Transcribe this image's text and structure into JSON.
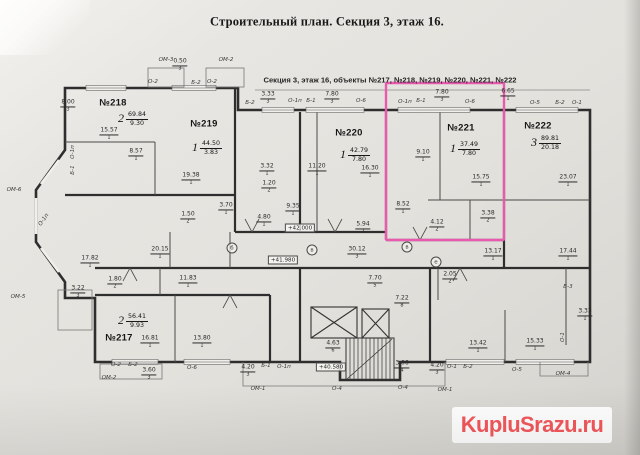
{
  "header": {
    "title": "Строительный план. Секция 3, этаж 16.",
    "subtitle": "Секция 3, этаж 16, объекты №217, №218, №219, №220, №221, №222"
  },
  "watermark": {
    "text": "KupluSrazu.ru",
    "color": "#f4555a",
    "background": "#ffffff"
  },
  "plan": {
    "ink_color": "#2e2e2e",
    "paper_color": "#e6e4e0",
    "highlight_color": "#e85aae",
    "highlighted_unit": "№221",
    "apartments": [
      {
        "id": "№218",
        "rooms": "2",
        "total_area": "69.84",
        "living_area": "9.30",
        "id_x": 113,
        "id_y": 103,
        "area_x": 133,
        "area_y": 119
      },
      {
        "id": "№219",
        "rooms": "1",
        "total_area": "44.50",
        "living_area": "3.83",
        "id_x": 204,
        "id_y": 124,
        "area_x": 207,
        "area_y": 148
      },
      {
        "id": "№220",
        "rooms": "1",
        "total_area": "42.79",
        "living_area": "7.80",
        "id_x": 349,
        "id_y": 133,
        "area_x": 355,
        "area_y": 155
      },
      {
        "id": "№221",
        "rooms": "1",
        "total_area": "37.49",
        "living_area": "7.80",
        "id_x": 461,
        "id_y": 128,
        "area_x": 465,
        "area_y": 149
      },
      {
        "id": "№222",
        "rooms": "3",
        "total_area": "89.81",
        "living_area": "20.18",
        "id_x": 538,
        "id_y": 126,
        "area_x": 546,
        "area_y": 143
      },
      {
        "id": "№217",
        "rooms": "2",
        "total_area": "56.41",
        "living_area": "9.93",
        "id_x": 119,
        "id_y": 338,
        "area_x": 133,
        "area_y": 321
      }
    ],
    "dims": [
      {
        "t": "15.57",
        "d": "1",
        "x": 109,
        "y": 134
      },
      {
        "t": "8.57",
        "d": "1",
        "x": 136,
        "y": 155
      },
      {
        "t": "19.38",
        "d": "1",
        "x": 191,
        "y": 179
      },
      {
        "t": "1.50",
        "d": "2",
        "x": 188,
        "y": 218
      },
      {
        "t": "3.70",
        "d": "1",
        "x": 226,
        "y": 209
      },
      {
        "t": "3.32",
        "d": "1",
        "x": 267,
        "y": 170
      },
      {
        "t": "1.20",
        "d": "2",
        "x": 269,
        "y": 187
      },
      {
        "t": "9.35",
        "d": "1",
        "x": 293,
        "y": 210
      },
      {
        "t": "4.80",
        "d": "1",
        "x": 264,
        "y": 221
      },
      {
        "t": "11.20",
        "d": "1",
        "x": 317,
        "y": 170
      },
      {
        "t": "16.30",
        "d": "1",
        "x": 370,
        "y": 172
      },
      {
        "t": "5.94",
        "d": "2",
        "x": 363,
        "y": 228
      },
      {
        "t": "9.10",
        "d": "1",
        "x": 423,
        "y": 156
      },
      {
        "t": "15.75",
        "d": "1",
        "x": 481,
        "y": 181
      },
      {
        "t": "8.52",
        "d": "1",
        "x": 403,
        "y": 208
      },
      {
        "t": "4.12",
        "d": "2",
        "x": 437,
        "y": 226
      },
      {
        "t": "3.38",
        "d": "2",
        "x": 488,
        "y": 217
      },
      {
        "t": "23.07",
        "d": "1",
        "x": 568,
        "y": 181
      },
      {
        "t": "20.15",
        "d": "1",
        "x": 160,
        "y": 253
      },
      {
        "t": "17.82",
        "d": "1",
        "x": 90,
        "y": 262
      },
      {
        "t": "1.80",
        "d": "2",
        "x": 115,
        "y": 283
      },
      {
        "t": "11.83",
        "d": "1",
        "x": 188,
        "y": 282
      },
      {
        "t": "3.22",
        "d": "3",
        "x": 78,
        "y": 292
      },
      {
        "t": "16.81",
        "d": "1",
        "x": 150,
        "y": 342
      },
      {
        "t": "13.80",
        "d": "1",
        "x": 202,
        "y": 342
      },
      {
        "t": "30.12",
        "d": "3",
        "x": 357,
        "y": 253
      },
      {
        "t": "7.70",
        "d": "5",
        "x": 375,
        "y": 282
      },
      {
        "t": "7.22",
        "d": "8",
        "x": 402,
        "y": 302
      },
      {
        "t": "2.05",
        "d": "2",
        "x": 450,
        "y": 278
      },
      {
        "t": "13.17",
        "d": "1",
        "x": 493,
        "y": 255
      },
      {
        "t": "17.44",
        "d": "1",
        "x": 568,
        "y": 255
      },
      {
        "t": "3.33",
        "d": "1",
        "x": 585,
        "y": 315
      },
      {
        "t": "13.42",
        "d": "1",
        "x": 478,
        "y": 347
      },
      {
        "t": "15.33",
        "d": "1",
        "x": 535,
        "y": 345
      },
      {
        "t": "4.63",
        "d": "6",
        "x": 333,
        "y": 347
      },
      {
        "t": "3.06",
        "d": "4",
        "x": 402,
        "y": 367
      },
      {
        "t": "4.20",
        "d": "3",
        "x": 248,
        "y": 371
      },
      {
        "t": "3.60",
        "d": "3",
        "x": 149,
        "y": 374
      },
      {
        "t": "4.20",
        "d": "3",
        "x": 437,
        "y": 369
      },
      {
        "t": "8.00",
        "d": "3",
        "x": 68,
        "y": 106
      },
      {
        "t": "0.50",
        "d": "3",
        "x": 180,
        "y": 65
      },
      {
        "t": "3.33",
        "d": "3",
        "x": 268,
        "y": 98
      },
      {
        "t": "7.80",
        "d": "3",
        "x": 332,
        "y": 98
      },
      {
        "t": "7.80",
        "d": "3",
        "x": 442,
        "y": 96
      },
      {
        "t": "6.65",
        "d": "1",
        "x": 508,
        "y": 95
      }
    ],
    "tags": [
      {
        "t": "ОМ-3",
        "x": 166,
        "y": 60
      },
      {
        "t": "ОМ-2",
        "x": 226,
        "y": 60
      },
      {
        "t": "О-2",
        "x": 153,
        "y": 82
      },
      {
        "t": "Б-2",
        "x": 196,
        "y": 83
      },
      {
        "t": "О-2",
        "x": 212,
        "y": 82
      },
      {
        "t": "Б-2",
        "x": 250,
        "y": 103
      },
      {
        "t": "О-1п",
        "x": 295,
        "y": 101
      },
      {
        "t": "Б-1",
        "x": 311,
        "y": 101
      },
      {
        "t": "О-6",
        "x": 361,
        "y": 101
      },
      {
        "t": "О-1п",
        "x": 405,
        "y": 102
      },
      {
        "t": "Б-1",
        "x": 421,
        "y": 101
      },
      {
        "t": "О-6",
        "x": 470,
        "y": 102
      },
      {
        "t": "О-5",
        "x": 535,
        "y": 103
      },
      {
        "t": "Б-2",
        "x": 560,
        "y": 103
      },
      {
        "t": "О-1",
        "x": 577,
        "y": 103
      },
      {
        "t": "ОМ-6",
        "x": 14,
        "y": 190
      },
      {
        "t": "О-1п",
        "x": 73,
        "y": 152,
        "r": -90
      },
      {
        "t": "Б-1",
        "x": 73,
        "y": 170,
        "r": -90
      },
      {
        "t": "О-1п",
        "x": 44,
        "y": 220,
        "r": -55
      },
      {
        "t": "ОМ-5",
        "x": 18,
        "y": 297
      },
      {
        "t": "О-2",
        "x": 116,
        "y": 365
      },
      {
        "t": "Б-2",
        "x": 133,
        "y": 365
      },
      {
        "t": "ОМ-2",
        "x": 109,
        "y": 378
      },
      {
        "t": "О-6",
        "x": 192,
        "y": 368
      },
      {
        "t": "Б-1",
        "x": 266,
        "y": 366
      },
      {
        "t": "О-1п",
        "x": 284,
        "y": 367
      },
      {
        "t": "ОМ-1",
        "x": 258,
        "y": 389
      },
      {
        "t": "О-4",
        "x": 337,
        "y": 389
      },
      {
        "t": "О-4",
        "x": 403,
        "y": 388
      },
      {
        "t": "ОМ-1",
        "x": 445,
        "y": 390
      },
      {
        "t": "О-1",
        "x": 452,
        "y": 367
      },
      {
        "t": "Б-2",
        "x": 468,
        "y": 367
      },
      {
        "t": "О-5",
        "x": 517,
        "y": 370
      },
      {
        "t": "ОМ-4",
        "x": 563,
        "y": 374
      },
      {
        "t": "Б-3",
        "x": 568,
        "y": 287
      },
      {
        "t": "О-1",
        "x": 563,
        "y": 337,
        "r": -90
      }
    ],
    "elevations": [
      {
        "t": "+42.000",
        "x": 300,
        "y": 228
      },
      {
        "t": "+41.980",
        "x": 283,
        "y": 260
      },
      {
        "t": "+40.580",
        "x": 331,
        "y": 367
      }
    ],
    "bubbles": [
      {
        "t": "б",
        "x": 232,
        "y": 248
      },
      {
        "t": "в",
        "x": 312,
        "y": 250
      },
      {
        "t": "в",
        "x": 407,
        "y": 247
      },
      {
        "t": "е",
        "x": 436,
        "y": 262
      }
    ]
  }
}
